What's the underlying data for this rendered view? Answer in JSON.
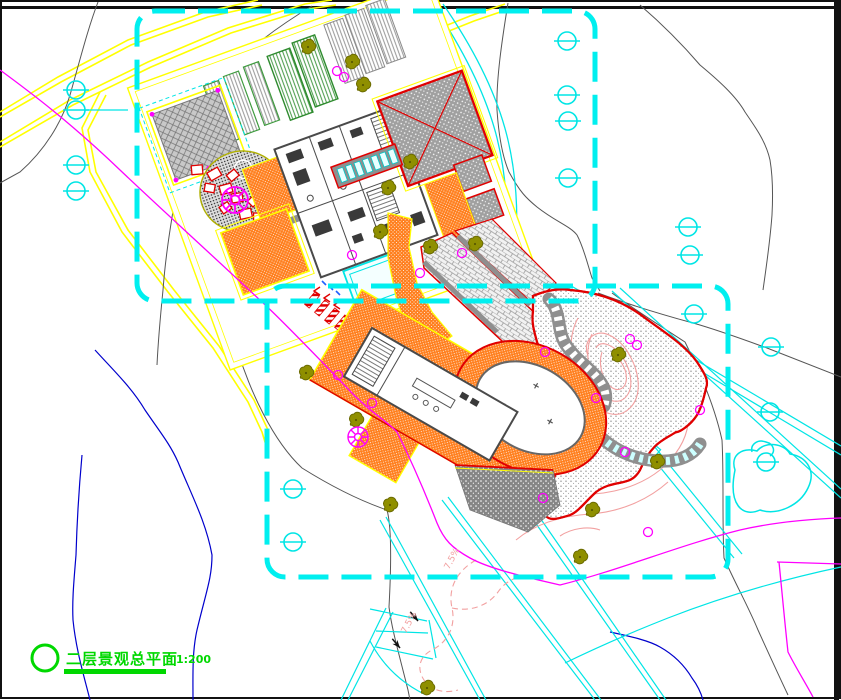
{
  "drawing": {
    "title": "二层景观总平面",
    "scale": "1:200",
    "slope_label_1": "7.5%",
    "slope_label_2": "7.5%"
  },
  "colors": {
    "boundary_dash_cyan": "#00EFEF",
    "contour_black": "#555555",
    "contour_magenta": "#FF00FF",
    "contour_blue": "#0000CC",
    "contour_pink": "#F2A0A0",
    "road_yellow": "#FFFF00",
    "paving_orange": "#FF7F1E",
    "accent_red": "#FF0000",
    "title_green": "#00D800",
    "tree_olive": "#8F8F00",
    "paving_gray": "#A0A0A0"
  }
}
